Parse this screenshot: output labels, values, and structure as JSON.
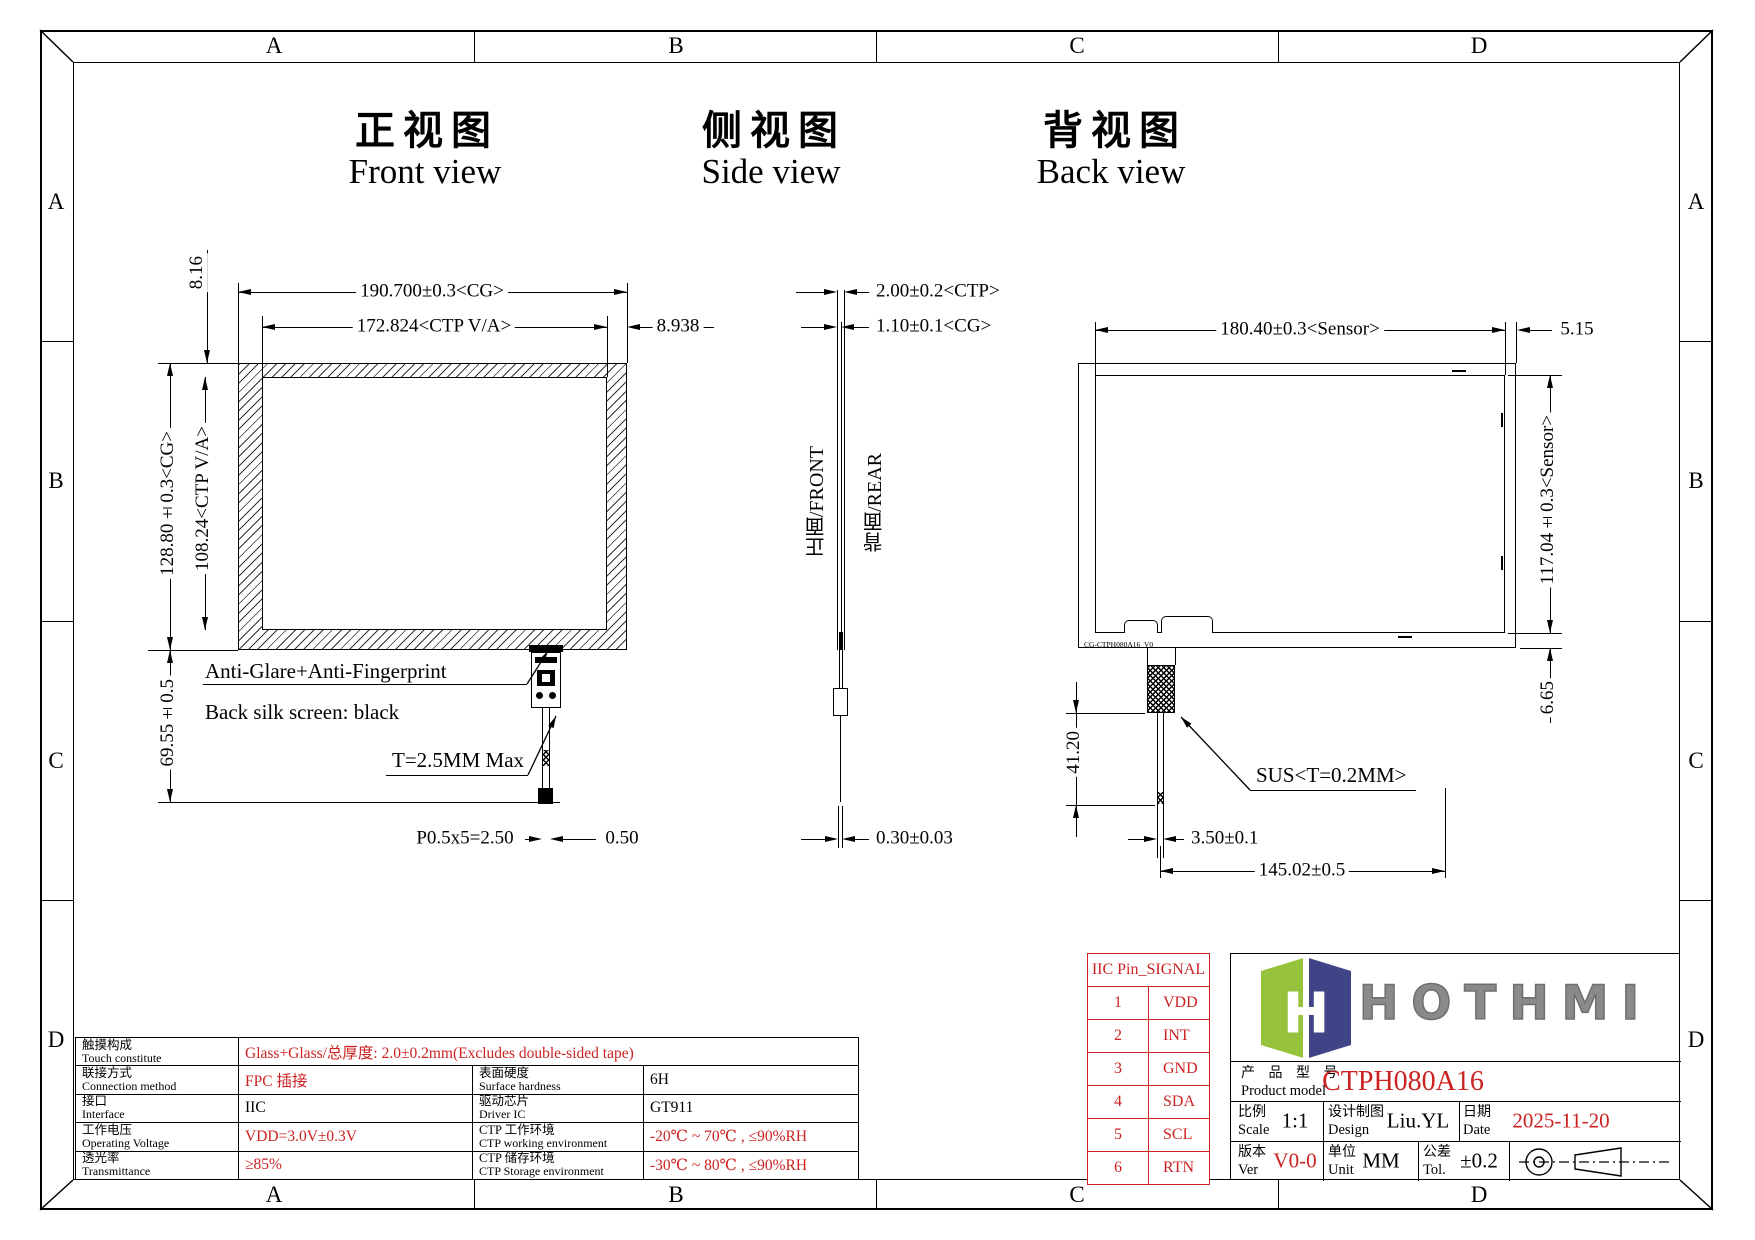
{
  "colors": {
    "red": "#cc2222",
    "line": "#000000",
    "logo_green": "#96c23c",
    "logo_navy": "#3f4487",
    "logo_gray": "#8a8a8a"
  },
  "frame": {
    "cols": [
      "A",
      "B",
      "C",
      "D"
    ],
    "rows": [
      "A",
      "B",
      "C",
      "D"
    ]
  },
  "titles": {
    "front_cn": "正视图",
    "front_en": "Front view",
    "side_cn": "侧视图",
    "side_en": "Side view",
    "back_cn": "背视图",
    "back_en": "Back view"
  },
  "front": {
    "dim_width_cg": "190.700±0.3<CG>",
    "dim_width_va": "172.824<CTP V/A>",
    "dim_right_margin": "8.938",
    "dim_top_margin": "8.16",
    "dim_height_cg": "128.80±0.3<CG>",
    "dim_height_va": "108.24<CTP V/A>",
    "dim_tail": "69.55±0.5",
    "note_glare": "Anti-Glare+Anti-Fingerprint",
    "note_silk": "Back silk screen: black",
    "note_thickness": "T=2.5MM Max",
    "dim_pitch": "P0.5x5=2.50",
    "dim_tail_width": "0.50"
  },
  "side": {
    "dim_ctp": "2.00±0.2<CTP>",
    "dim_cg": "1.10±0.1<CG>",
    "label_front": "正面/FRONT",
    "label_rear": "背面/REAR",
    "dim_film": "0.30±0.03"
  },
  "back": {
    "dim_width_sensor": "180.40±0.3<Sensor>",
    "dim_right_margin": "5.15",
    "dim_height_sensor": "117.04±0.3<Sensor>",
    "dim_bottom_margin": "6.65",
    "dim_fpc_offset": "41.20",
    "note_sus": "SUS<T=0.2MM>",
    "dim_tail_width": "3.50±0.1",
    "dim_tail_x": "145.02±0.5",
    "edge_label": "CG-CTPH080A16_V0"
  },
  "iic_table": {
    "title": "IIC Pin_SIGNAL",
    "rows": [
      [
        "1",
        "VDD"
      ],
      [
        "2",
        "INT"
      ],
      [
        "3",
        "GND"
      ],
      [
        "4",
        "SDA"
      ],
      [
        "5",
        "SCL"
      ],
      [
        "6",
        "RTN"
      ]
    ]
  },
  "logo": {
    "brand": "HOTHMI",
    "mark_letter": "H"
  },
  "title_block": {
    "model_label_cn": "产 品 型 号",
    "model_label_en": "Product model",
    "model_value": "CTPH080A16",
    "scale_label_cn": "比例",
    "scale_label_en": "Scale",
    "scale_value": "1:1",
    "design_label_cn": "设计制图",
    "design_label_en": "Design",
    "design_value": "Liu.YL",
    "date_label_cn": "日期",
    "date_label_en": "Date",
    "date_value": "2025-11-20",
    "ver_label_cn": "版本",
    "ver_label_en": "Ver",
    "ver_value": "V0-0",
    "unit_label_cn": "单位",
    "unit_label_en": "Unit",
    "unit_value": "MM",
    "tol_label_cn": "公差",
    "tol_label_en": "Tol.",
    "tol_value": "±0.2"
  },
  "spec_table": {
    "rows": [
      {
        "label_cn": "触摸构成",
        "label_en": "Touch constitute",
        "value": "Glass+Glass/总厚度: 2.0±0.2mm(Excludes double-sided tape)"
      },
      {
        "label_cn": "联接方式",
        "label_en": "Connection method",
        "value": "FPC 插接",
        "label2_cn": "表面硬度",
        "label2_en": "Surface hardness",
        "value2": "6H"
      },
      {
        "label_cn": "接口",
        "label_en": "Interface",
        "value": "IIC",
        "label2_cn": "驱动芯片",
        "label2_en": "Driver IC",
        "value2": "GT911"
      },
      {
        "label_cn": "工作电压",
        "label_en": "Operating Voltage",
        "value": "VDD=3.0V±0.3V",
        "label2_cn": "CTP 工作环境",
        "label2_en": "CTP working environment",
        "value2": "-20℃ ~ 70℃ , ≤90%RH"
      },
      {
        "label_cn": "透光率",
        "label_en": "Transmittance",
        "value": "≥85%",
        "label2_cn": "CTP 储存环境",
        "label2_en": "CTP Storage environment",
        "value2": "-30℃ ~ 80℃ , ≤90%RH"
      }
    ]
  }
}
